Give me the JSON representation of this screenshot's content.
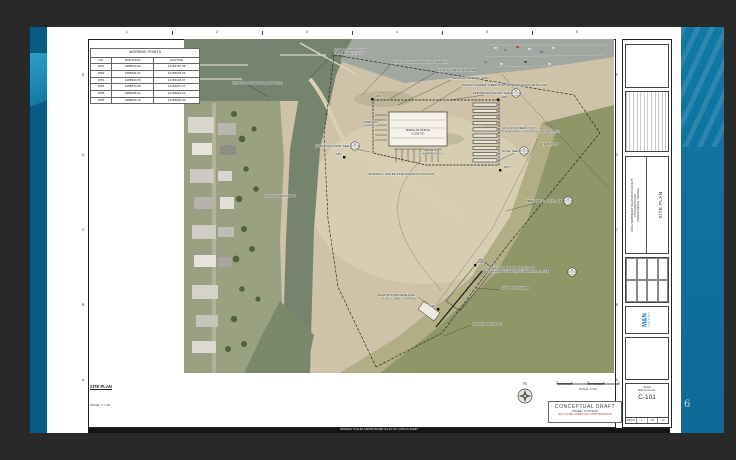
{
  "slide": {
    "page_number": "6"
  },
  "sheet": {
    "grid_top": [
      "1",
      "2",
      "3",
      "4",
      "5",
      "6"
    ],
    "grid_side": [
      "E",
      "D",
      "C",
      "B",
      "A"
    ],
    "working_points": {
      "title": "WORKING POINTS",
      "columns": [
        "NO.",
        "NORTHING",
        "EASTING"
      ],
      "rows": [
        [
          "WP1",
          "3488513.08",
          "12166157.88"
        ],
        [
          "WP2",
          "3488494.01",
          "12166099.56"
        ],
        [
          "WP3",
          "3488390.05",
          "12166136.07"
        ],
        [
          "WP4",
          "3488370.30",
          "12166037.27"
        ],
        [
          "WP5",
          "3488104.21",
          "12165824.03"
        ],
        [
          "WP6",
          "3488090.10",
          "12165946.03"
        ]
      ]
    },
    "view_label": {
      "title": "SITE PLAN",
      "scale": "SCALE: 1\" = 40'"
    },
    "north": "N",
    "scalebar": "SCALE: 1\"=40'",
    "stamp": {
      "title": "CONCEPTUAL DRAFT",
      "issued": "ISSUED: 12/20/2018",
      "warning": "NOT TO BE USED FOR CONSTRUCTION"
    },
    "note_bar": "DRAWING SCALES SHOWN BASED ON 22\"x34\" (ANSI D) SHEET",
    "title_block": {
      "project1": "USCG TEMPORARY RELOCATION FACILITY",
      "project2": "LYNNHAVEN INLET",
      "project3": "VIRGINIA BEACH, VIRGINIA",
      "sheet_title": "SITE PLAN",
      "logo_mark": "M&N",
      "logo_name": "moffatt & nichol",
      "ref_label1": "Sheet",
      "ref_label2": "Reference No.",
      "number": "C-101",
      "size": "ANSI D",
      "index": "1",
      "of": "OF",
      "total": "10"
    }
  },
  "map": {
    "labels": [
      {
        "line1": "ENTRANCE LOCATION",
        "line2": "FROM PARKING LOT"
      },
      {
        "line1": "EXISTING WATER HOOKUP (APPROX)"
      },
      {
        "line1": "EXISTING BOARDWALK (APPROX)"
      },
      {
        "line1": "EXISTING TRANSFORMER"
      },
      {
        "line1": "SEWAGE HOLDING TANK"
      },
      {
        "line1": "WATER, POWER, FIBER HOOKUP FOR MODULAR OFFICE"
      },
      {
        "line1": "PERIMETER FENCE, SEE"
      },
      {
        "line1": "PARKING",
        "line2": "(APPROX)"
      },
      {
        "line1": "MODULAR OFFICE",
        "line2": "(5,558 SF)"
      },
      {
        "line1": "40' CONTAINERS, TYP",
        "line2": "(TEMPORARY STORAGE WAIVER REQ)"
      },
      {
        "line1": "ENTRANCE GATE, SEE"
      },
      {
        "line1": "PARKING",
        "line2": "(UNIMPROVED)"
      },
      {
        "line1": "GATE, SEE"
      },
      {
        "line1": "ATFP LIMITS"
      },
      {
        "line1": "BURIED 1\" WATER LINE FOR BOAT HOOKUP"
      },
      {
        "line1": "PEDESTRIAN PATH, SEE"
      },
      {
        "line1": "SAFETY HAZARD MARKINGS ON",
        "line2": "BULKHEAD WITH JERSEY BARRIERS, SEE"
      },
      {
        "line1": "CITY BOAT BERTH"
      },
      {
        "line1": "MARINA TYPE PEDESTAL,",
        "line2": "FUEL CUBE STORAGE"
      },
      {
        "line1": "PARCEL BOUNDARY"
      },
      {
        "line1": "8' MIN WATER DEPTH"
      }
    ],
    "wp": [
      "WP1",
      "WP2",
      "WP3",
      "WP4",
      "WP5",
      "WP6"
    ],
    "details": [
      {
        "num": "03",
        "sheet": "C-501"
      },
      {
        "num": "04",
        "sheet": "C-501"
      },
      {
        "num": "04",
        "sheet": "C-501"
      },
      {
        "num": "05",
        "sheet": "C-501"
      },
      {
        "num": "06",
        "sheet": "C-501"
      }
    ]
  }
}
